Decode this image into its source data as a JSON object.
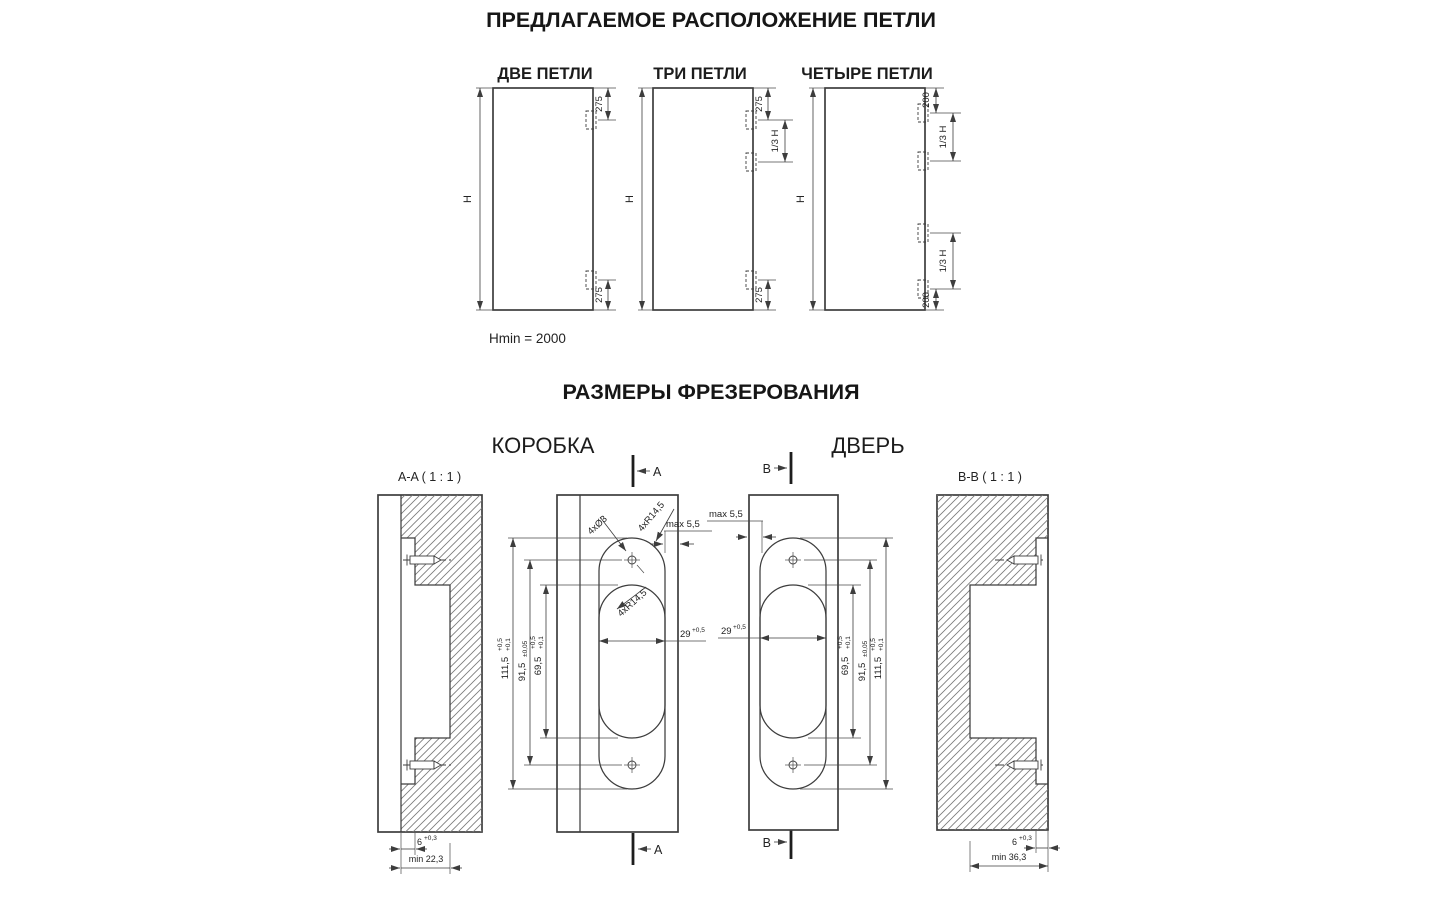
{
  "colors": {
    "line": "#3d3d3d",
    "hatch": "#787878",
    "text": "#232323"
  },
  "placement": {
    "title": "ПРЕДЛАГАЕМОЕ РАСПОЛОЖЕНИЕ ПЕТЛИ",
    "hmin": "Hmin = 2000",
    "doors": [
      {
        "label": "ДВЕ ПЕТЛИ",
        "h": "H",
        "d1": "275",
        "d2": "275"
      },
      {
        "label": "ТРИ ПЕТЛИ",
        "h": "H",
        "d1": "275",
        "d2": "1/3 H",
        "d3": "275"
      },
      {
        "label": "ЧЕТЫРЕ ПЕТЛИ",
        "h": "H",
        "d1": "200",
        "d2": "1/3 H",
        "d3": "1/3 H",
        "d4": "200"
      }
    ]
  },
  "milling": {
    "title": "РАЗМЕРЫ ФРЕЗЕРОВАНИЯ",
    "frame_title": "КОРОБКА",
    "door_title": "ДВЕРЬ",
    "section_a": "A-A ( 1 : 1 )",
    "section_b": "B-B ( 1 : 1 )",
    "a": "A",
    "b": "B",
    "holes": "4xØ3",
    "radius": "4xR14,5",
    "max55": "max 5,5",
    "w29": "29",
    "w29_tol": "+0,5",
    "v111": "111,5",
    "v111_t1": "+0,5",
    "v111_t2": "+0,1",
    "v91": "91,5",
    "v91_t": "±0,05",
    "v69": "69,5",
    "v69_t1": "+0,5",
    "v69_t2": "+0,1",
    "d6": "6",
    "d6_tol": "+0,3",
    "min_frame": "min 22,3",
    "min_door": "min 36,3"
  }
}
